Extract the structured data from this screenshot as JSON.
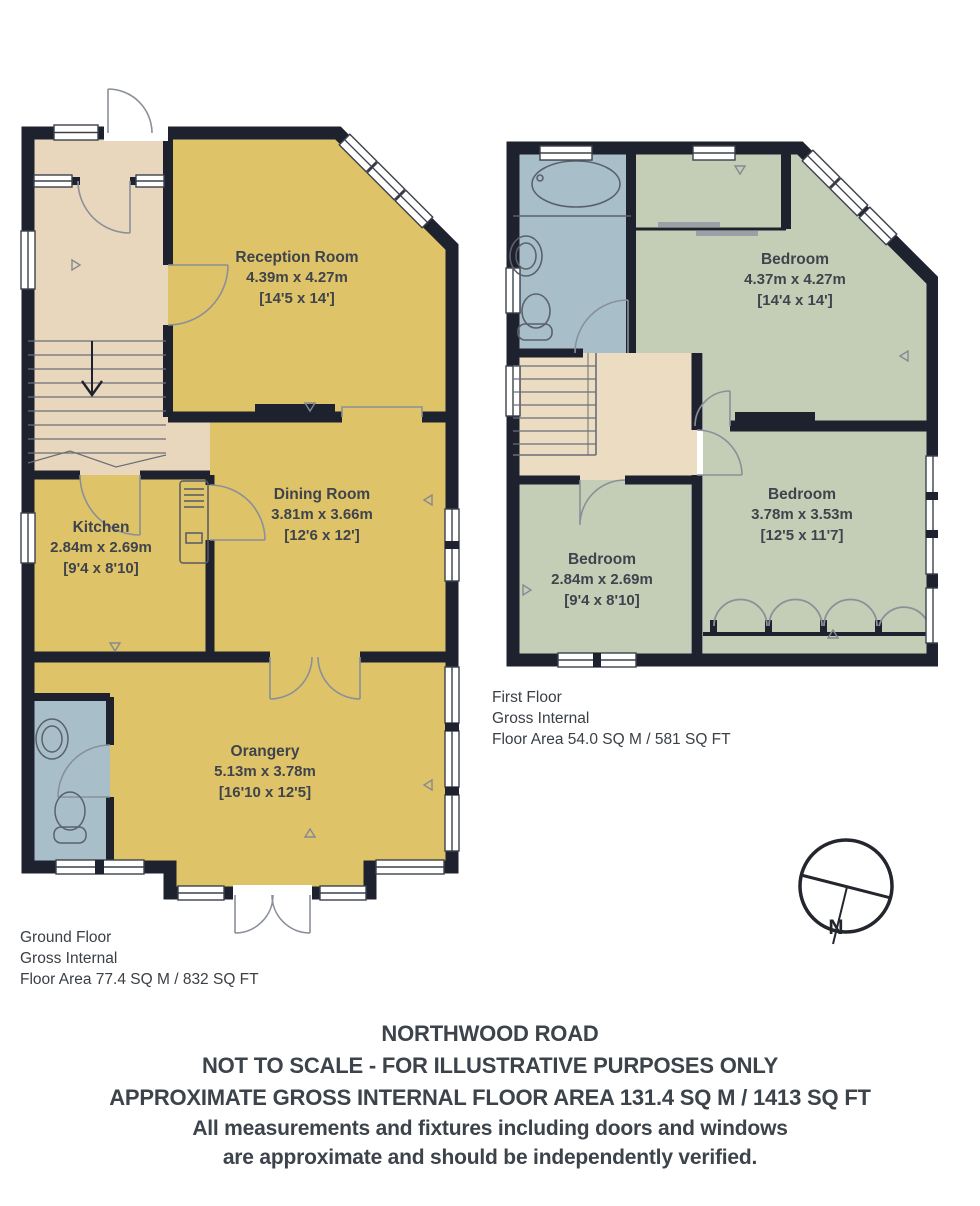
{
  "ground_floor": {
    "rooms": [
      {
        "name": "Reception Room",
        "metric": "4.39m x 4.27m",
        "imperial": "[14'5 x 14']"
      },
      {
        "name": "Dining Room",
        "metric": "3.81m x 3.66m",
        "imperial": "[12'6 x 12']"
      },
      {
        "name": "Kitchen",
        "metric": "2.84m x 2.69m",
        "imperial": "[9'4 x 8'10]"
      },
      {
        "name": "Orangery",
        "metric": "5.13m x 3.78m",
        "imperial": "[16'10 x 12'5]"
      }
    ],
    "caption": [
      "Ground Floor",
      "Gross Internal",
      "Floor Area 77.4 SQ M / 832 SQ FT"
    ]
  },
  "first_floor": {
    "rooms": [
      {
        "name": "Bedroom",
        "metric": "4.37m x 4.27m",
        "imperial": "[14'4 x 14']"
      },
      {
        "name": "Bedroom",
        "metric": "3.78m x 3.53m",
        "imperial": "[12'5 x 11'7]"
      },
      {
        "name": "Bedroom",
        "metric": "2.84m x 2.69m",
        "imperial": "[9'4 x 8'10]"
      }
    ],
    "caption": [
      "First Floor",
      "Gross Internal",
      "Floor Area 54.0 SQ M / 581 SQ FT"
    ]
  },
  "compass": {
    "north_label": "N"
  },
  "footer": {
    "lines": [
      "NORTHWOOD ROAD",
      "NOT TO SCALE - FOR ILLUSTRATIVE PURPOSES ONLY",
      "APPROXIMATE GROSS INTERNAL FLOOR AREA 131.4 SQ M / 1413 SQ FT",
      "All measurements and fixtures including doors and windows",
      "are approximate and should be independently verified."
    ]
  },
  "colors": {
    "wall": "#1e212e",
    "living_rooms": "#dfc368",
    "hall_landing": "#e8d7bc",
    "bathrooms": "#a8bfca",
    "bedrooms": "#c4ceb7",
    "background": "#ffffff",
    "label_text": "#3f444c"
  }
}
